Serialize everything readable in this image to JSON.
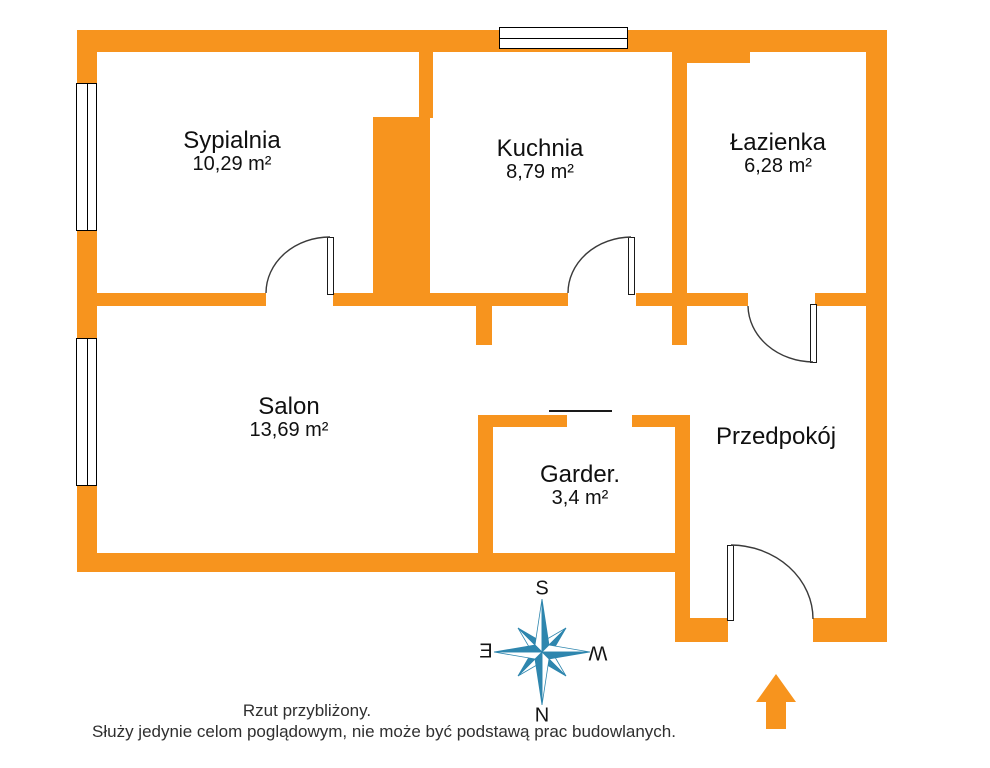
{
  "title": "Rzut mieszkania",
  "rooms": [
    {
      "id": "sypialnia",
      "name": "Sypialnia",
      "area": "10,29 m²"
    },
    {
      "id": "kuchnia",
      "name": "Kuchnia",
      "area": "8,79 m²"
    },
    {
      "id": "lazienka",
      "name": "Łazienka",
      "area": "6,28 m²"
    },
    {
      "id": "salon",
      "name": "Salon",
      "area": "13,69 m²"
    },
    {
      "id": "garderoba",
      "name": "Garder.",
      "area": "3,4 m²"
    },
    {
      "id": "przedpokoj",
      "name": "Przedpokój",
      "area": ""
    }
  ],
  "compass": {
    "top": "S",
    "bottom": "N",
    "left": "E",
    "right": "W"
  },
  "disclaimer": {
    "line1": "Rzut przybliżony.",
    "line2": "Służy jedynie celom poglądowym, nie może być podstawą prac budowlanych."
  },
  "colors": {
    "wall": "#F7941E",
    "compass": "#2E86AE",
    "text": "#2F2F2F"
  }
}
